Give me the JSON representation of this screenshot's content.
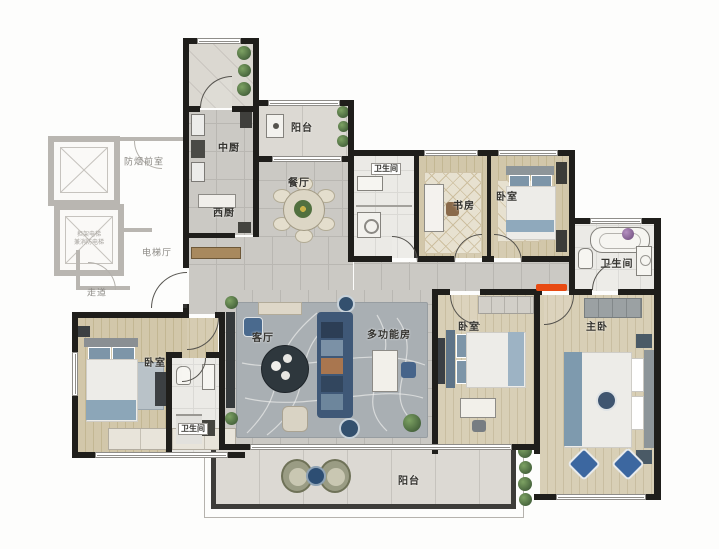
{
  "plan": {
    "core": {
      "vestibule": "防烟前室",
      "elevator_hall": "电梯厅",
      "corridor": "走道",
      "elevator_note": "担架电梯\n兼消防电梯"
    },
    "rooms": {
      "chinese_kitchen": "中厨",
      "west_kitchen": "西厨",
      "balcony_top": "阳台",
      "dining": "餐厅",
      "bath_top": "卫生间",
      "study": "书房",
      "bedroom_top_right": "卧室",
      "bath_master": "卫生间",
      "master_bedroom": "主卧",
      "bedroom_mid_right": "卧室",
      "living": "客厅",
      "multifunction": "多功能房",
      "bedroom_bottom_left": "卧室",
      "bath_bottom_left": "卫生间",
      "balcony_bottom": "阳台"
    },
    "colors": {
      "wall": "#1f1e1b",
      "core_gray": "#b9b6b1",
      "wood_floor": "#d2c7aa",
      "gray_tile": "#cbc9c4",
      "white_tile": "#ebeae6",
      "rug_gray": "#a9afb3",
      "sofa_blue": "#3f5877",
      "accent_red": "#e84a12",
      "plant_green": "#567448"
    }
  }
}
